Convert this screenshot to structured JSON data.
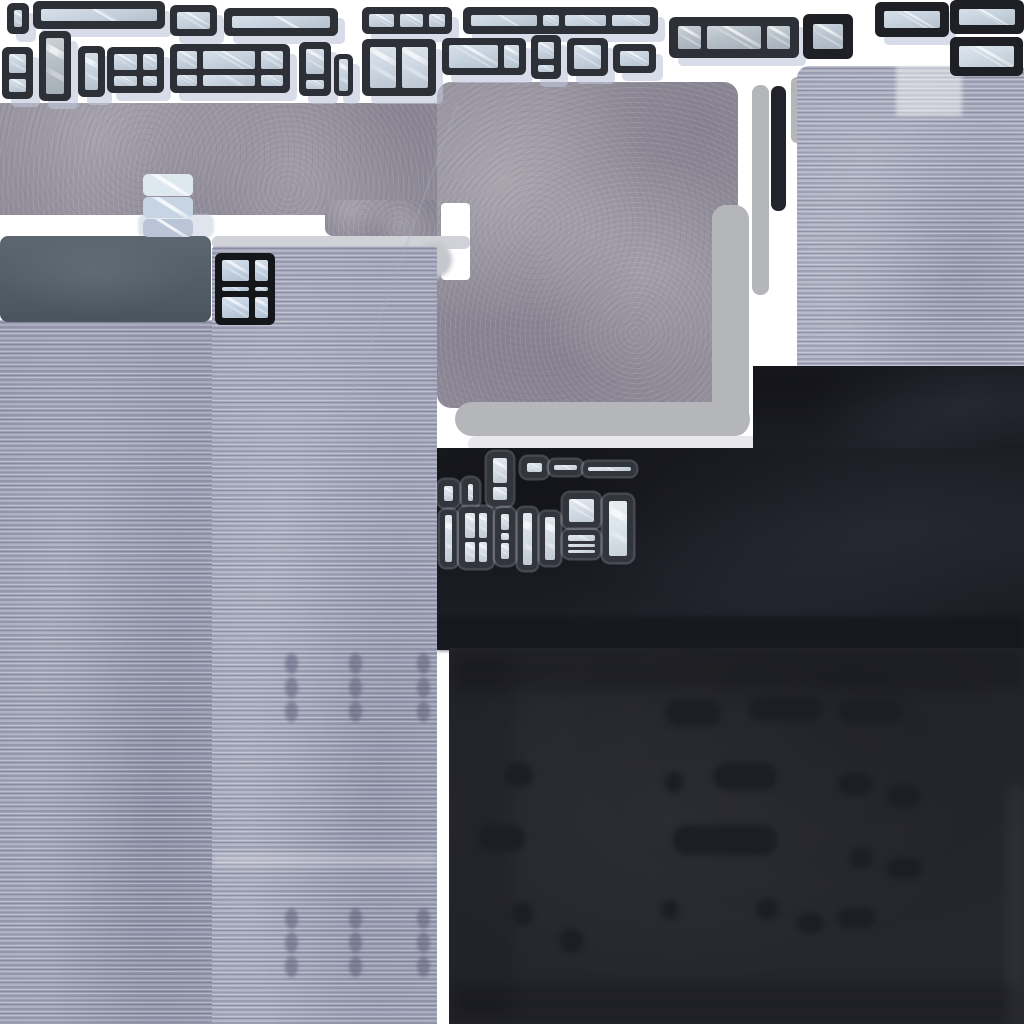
{
  "meta": {
    "description": "hand-painted building texture atlas sprite sheet",
    "canvas": {
      "width": 1024,
      "height": 1024,
      "background": "#ffffff"
    }
  },
  "palette": {
    "background_white": "#ffffff",
    "window_frame_charcoal": "#2d3037",
    "window_frame_black": "#1e2025",
    "glass_blue": "#c7d3df",
    "glass_gray": "#b6bfc8",
    "glass_bright": "#d4dde6",
    "concrete_gray": "#938f9b",
    "siding_lavender_left": "#9b9eb2",
    "siding_lavender_right": "#a2a5b9",
    "siding_panel_topright": "#a6a9bc",
    "slate_cap": "#4e5a64",
    "dark_wall": "#1c1d24",
    "dark_roof": "#26272e",
    "roof_blob": "#1d1e25",
    "pipe_gray": "#b5b6ba",
    "pipe_light": "#e8e8ec",
    "shadow_periwinkle": "rgba(188,197,216,0.60)"
  },
  "regions": [
    {
      "name": "concrete-wall-strip",
      "kind": "concrete",
      "x": 0,
      "y": 103,
      "w": 437,
      "h": 112,
      "r": "0 0 8px 0"
    },
    {
      "name": "concrete-wall-strip-step",
      "kind": "concrete",
      "x": 325,
      "y": 200,
      "w": 112,
      "h": 36,
      "r": "0 0 0 8px"
    },
    {
      "name": "concrete-wall-square",
      "kind": "concrete",
      "x": 437,
      "y": 82,
      "w": 301,
      "h": 326,
      "r": "14px"
    },
    {
      "name": "concrete-notch-white",
      "kind": "flat",
      "x": 441,
      "y": 203,
      "w": 29,
      "h": 77,
      "c": "#ffffff",
      "r": "4px"
    },
    {
      "name": "ledge-strip",
      "kind": "flat",
      "x": 212,
      "y": 236,
      "w": 258,
      "h": 13,
      "c": "#d0d2d7",
      "r": "6px"
    },
    {
      "name": "ledge-bump",
      "kind": "flat",
      "x": 416,
      "y": 242,
      "w": 36,
      "h": 36,
      "c": "#c5c7cd",
      "r": "50%",
      "blur": 2
    },
    {
      "name": "chimney-shadow",
      "kind": "flat",
      "x": 138,
      "y": 214,
      "w": 76,
      "h": 24,
      "c": "rgba(198,207,222,0.55)",
      "r": "8px",
      "blur": 1
    },
    {
      "name": "pipe-horizontal",
      "kind": "flat",
      "x": 455,
      "y": 402,
      "w": 295,
      "h": 34,
      "c": "#b5b6ba",
      "r": "17px"
    },
    {
      "name": "pipe-horizontal-light",
      "kind": "flat",
      "x": 468,
      "y": 436,
      "w": 334,
      "h": 16,
      "c": "#e8e8ec",
      "r": "8px"
    },
    {
      "name": "pipe-vertical-wide",
      "kind": "flat",
      "x": 712,
      "y": 205,
      "w": 37,
      "h": 231,
      "c": "#b5b6ba",
      "r": "14px"
    },
    {
      "name": "pipe-vertical-thin",
      "kind": "flat",
      "x": 752,
      "y": 85,
      "w": 17,
      "h": 210,
      "c": "#b5b6ba",
      "r": "8px"
    },
    {
      "name": "pipe-stub",
      "kind": "flat",
      "x": 791,
      "y": 77,
      "w": 13,
      "h": 66,
      "c": "#b5b6ba",
      "r": "6px"
    },
    {
      "name": "antenna-black-bar",
      "kind": "flat",
      "x": 771,
      "y": 86,
      "w": 15,
      "h": 125,
      "c": "#23242b",
      "r": "7px"
    },
    {
      "name": "siding-panel-top-right",
      "kind": "corrugated",
      "x": 797,
      "y": 66,
      "w": 227,
      "h": 300,
      "base": "#a6a9bc",
      "r": "12px 4px 0 0"
    },
    {
      "name": "siding-haze-patch",
      "kind": "flat",
      "x": 896,
      "y": 64,
      "w": 66,
      "h": 52,
      "c": "rgba(255,255,255,0.45)",
      "blur": 2
    },
    {
      "name": "dark-wall-right",
      "kind": "darkwall",
      "x": 753,
      "y": 366,
      "w": 271,
      "h": 96
    },
    {
      "name": "dark-wall-main",
      "kind": "darkwall",
      "x": 437,
      "y": 448,
      "w": 587,
      "h": 202
    },
    {
      "name": "dark-wall-bottom-band",
      "kind": "flat",
      "x": 437,
      "y": 616,
      "w": 587,
      "h": 34,
      "c": "#17181f",
      "o": 0.85,
      "blur": 2
    },
    {
      "name": "roof-texture",
      "kind": "roof",
      "x": 449,
      "y": 648,
      "w": 575,
      "h": 376,
      "shades": [
        {
          "x": 0,
          "y": 0,
          "w": 575,
          "h": 42,
          "c": "rgba(0,0,0,0.16)"
        },
        {
          "x": 0,
          "y": 336,
          "w": 575,
          "h": 40,
          "c": "rgba(0,0,0,0.16)"
        },
        {
          "x": 0,
          "y": 0,
          "w": 64,
          "h": 376,
          "c": "rgba(0,0,0,0.10)"
        },
        {
          "x": 559,
          "y": 140,
          "w": 16,
          "h": 236,
          "c": "rgba(255,255,255,0.05)"
        }
      ],
      "blobs": [
        {
          "x": 216,
          "y": 52,
          "w": 56,
          "h": 26
        },
        {
          "x": 299,
          "y": 49,
          "w": 74,
          "h": 24
        },
        {
          "x": 389,
          "y": 52,
          "w": 64,
          "h": 22
        },
        {
          "x": 56,
          "y": 115,
          "w": 28,
          "h": 24
        },
        {
          "x": 216,
          "y": 124,
          "w": 18,
          "h": 21
        },
        {
          "x": 264,
          "y": 115,
          "w": 64,
          "h": 27
        },
        {
          "x": 389,
          "y": 125,
          "w": 34,
          "h": 22
        },
        {
          "x": 438,
          "y": 137,
          "w": 33,
          "h": 22
        },
        {
          "x": 29,
          "y": 177,
          "w": 47,
          "h": 26
        },
        {
          "x": 224,
          "y": 177,
          "w": 104,
          "h": 30
        },
        {
          "x": 401,
          "y": 200,
          "w": 23,
          "h": 20
        },
        {
          "x": 438,
          "y": 210,
          "w": 35,
          "h": 20
        },
        {
          "x": 63,
          "y": 254,
          "w": 21,
          "h": 23
        },
        {
          "x": 213,
          "y": 252,
          "w": 16,
          "h": 20
        },
        {
          "x": 308,
          "y": 250,
          "w": 21,
          "h": 22
        },
        {
          "x": 348,
          "y": 265,
          "w": 26,
          "h": 20
        },
        {
          "x": 389,
          "y": 260,
          "w": 37,
          "h": 20
        },
        {
          "x": 111,
          "y": 280,
          "w": 23,
          "h": 25
        }
      ],
      "blob_color": "#1d1e25"
    },
    {
      "name": "siding-tower-right",
      "kind": "corrugated",
      "x": 212,
      "y": 246,
      "w": 225,
      "h": 778,
      "base": "#a2a5b9",
      "r": "4px 4px 0 0",
      "bands": [
        {
          "x": 0,
          "y": 607,
          "w": 225,
          "h": 14,
          "c": "rgba(255,255,255,0.22)"
        }
      ],
      "rivets": {
        "cols": [
          73,
          137,
          205
        ],
        "rows": [
          407,
          431,
          455,
          662,
          686,
          710
        ],
        "w": 13,
        "h": 21,
        "c": "rgba(88,92,118,0.5)"
      }
    },
    {
      "name": "siding-tower-left",
      "kind": "corrugated",
      "x": 0,
      "y": 320,
      "w": 212,
      "h": 704,
      "base": "#9b9eb2"
    },
    {
      "name": "rooftop-slate-cap",
      "kind": "cap",
      "x": 0,
      "y": 236,
      "w": 211,
      "h": 86,
      "r": "8px"
    },
    {
      "name": "scratch-line",
      "kind": "flat",
      "x": 400,
      "y": 95,
      "w": 2,
      "h": 330,
      "c": "rgba(170,175,190,0.30)",
      "rot": 20
    }
  ],
  "chimney": {
    "name": "glass-chimney",
    "x": 143,
    "y": 174,
    "w": 50,
    "h": 63,
    "segments": [
      {
        "c": "#dde8ef",
        "h": 1.1
      },
      {
        "c": "#c6d4e3",
        "h": 1.0
      },
      {
        "c": "#b9c4d6",
        "h": 0.9
      }
    ]
  },
  "window_defaults": {
    "frame": "#2d3037",
    "glass": "#c7d3df",
    "frame_width": 7,
    "mullion": 6,
    "radius": 6,
    "shadow": true
  },
  "windows": [
    {
      "name": "window-sprite-tiny",
      "x": 7,
      "y": 3,
      "w": 22,
      "h": 31
    },
    {
      "name": "window-sprite-long-top",
      "x": 33,
      "y": 1,
      "w": 132,
      "h": 28,
      "f": 8
    },
    {
      "name": "window-sprite-square-small",
      "x": 170,
      "y": 5,
      "w": 47,
      "h": 31
    },
    {
      "name": "window-sprite-wide",
      "x": 224,
      "y": 8,
      "w": 114,
      "h": 28,
      "f": 8
    },
    {
      "name": "window-sprite-strip-3pane",
      "x": 362,
      "y": 7,
      "w": 90,
      "h": 27,
      "cols": [
        1.6,
        1.5,
        1
      ]
    },
    {
      "name": "window-sprite-strip-4pane",
      "x": 463,
      "y": 7,
      "w": 195,
      "h": 27,
      "f": 8,
      "cols": [
        4.5,
        1.1,
        2.8,
        2.6
      ]
    },
    {
      "name": "window-sprite-banded",
      "x": 669,
      "y": 17,
      "w": 130,
      "h": 41,
      "f": 9,
      "cols": [
        1,
        2.4,
        1
      ],
      "glass": "#b6bfc8"
    },
    {
      "name": "window-sprite-square-thick",
      "x": 803,
      "y": 14,
      "w": 50,
      "h": 45,
      "f": 10,
      "frame": "#1e2025",
      "glass": "#b9c4cf",
      "shadow": false
    },
    {
      "name": "window-sprite-black-wide",
      "x": 875,
      "y": 2,
      "w": 74,
      "h": 35,
      "f": 9,
      "frame": "#1e2025"
    },
    {
      "name": "window-sprite-black-corner",
      "x": 950,
      "y": 0,
      "w": 74,
      "h": 34,
      "f": 9,
      "frame": "#1e2025",
      "shadow": false
    },
    {
      "name": "window-sprite-black-lower",
      "x": 950,
      "y": 37,
      "w": 73,
      "h": 39,
      "f": 9,
      "frame": "#1e2025",
      "glass": "#cfdae4",
      "shadow": false
    },
    {
      "name": "window-sprite-stacked",
      "x": 2,
      "y": 47,
      "w": 31,
      "h": 52,
      "rows": [
        1.4,
        1
      ]
    },
    {
      "name": "window-sprite-tall-gray",
      "x": 39,
      "y": 31,
      "w": 32,
      "h": 70,
      "glass": "#b6bec5"
    },
    {
      "name": "window-sprite-narrow",
      "x": 78,
      "y": 46,
      "w": 27,
      "h": 51
    },
    {
      "name": "window-sprite-grid-2x2",
      "x": 107,
      "y": 47,
      "w": 57,
      "h": 46,
      "cols": [
        1.6,
        1
      ],
      "rows": [
        1.6,
        1
      ]
    },
    {
      "name": "window-sprite-grid-3x2",
      "x": 170,
      "y": 44,
      "w": 120,
      "h": 49,
      "cols": [
        1,
        2.6,
        1.1
      ],
      "rows": [
        1.7,
        1
      ]
    },
    {
      "name": "window-sprite-stacked-2",
      "x": 299,
      "y": 42,
      "w": 32,
      "h": 54,
      "rows": [
        2.6,
        1
      ]
    },
    {
      "name": "window-sprite-slim",
      "x": 334,
      "y": 54,
      "w": 19,
      "h": 42,
      "f": 5,
      "m": 4
    },
    {
      "name": "window-sprite-double-door",
      "x": 362,
      "y": 39,
      "w": 74,
      "h": 57,
      "f": 8,
      "cols": [
        1,
        1
      ],
      "glass": "#cdd8e3"
    },
    {
      "name": "window-sprite-wide-2pane",
      "x": 442,
      "y": 38,
      "w": 84,
      "h": 37,
      "cols": [
        3.2,
        1
      ]
    },
    {
      "name": "window-sprite-stacked-3",
      "x": 531,
      "y": 35,
      "w": 30,
      "h": 44,
      "rows": [
        2.2,
        1
      ]
    },
    {
      "name": "window-sprite-square-mid",
      "x": 567,
      "y": 38,
      "w": 41,
      "h": 38
    },
    {
      "name": "window-sprite-small-wide",
      "x": 613,
      "y": 44,
      "w": 43,
      "h": 29
    },
    {
      "name": "cluster-window-tiny-a",
      "x": 438,
      "y": 480,
      "w": 21,
      "h": 27,
      "frame": "#33353c",
      "glass": "#d4dde6",
      "f": 6,
      "m": 4,
      "radius": 7,
      "shadow": false,
      "outline": true
    },
    {
      "name": "cluster-window-tiny-b",
      "x": 462,
      "y": 478,
      "w": 17,
      "h": 29,
      "frame": "#33353c",
      "glass": "#d4dde6",
      "f": 6,
      "m": 4,
      "radius": 7,
      "shadow": false,
      "outline": true
    },
    {
      "name": "cluster-window-tall-split",
      "x": 487,
      "y": 452,
      "w": 26,
      "h": 54,
      "rows": [
        2,
        1
      ],
      "frame": "#33353c",
      "glass": "#d4dde6",
      "f": 6,
      "m": 4,
      "radius": 7,
      "shadow": false,
      "outline": true
    },
    {
      "name": "cluster-window-small",
      "x": 521,
      "y": 457,
      "w": 27,
      "h": 21,
      "frame": "#33353c",
      "glass": "#d4dde6",
      "f": 6,
      "m": 4,
      "radius": 7,
      "shadow": false,
      "outline": true
    },
    {
      "name": "cluster-window-strip-a",
      "x": 549,
      "y": 460,
      "w": 33,
      "h": 15,
      "frame": "#33353c",
      "glass": "#d4dde6",
      "f": 5,
      "m": 4,
      "radius": 6,
      "shadow": false,
      "outline": true
    },
    {
      "name": "cluster-window-strip-b",
      "x": 583,
      "y": 462,
      "w": 53,
      "h": 14,
      "frame": "#33353c",
      "glass": "#d4dde6",
      "f": 5,
      "m": 4,
      "radius": 6,
      "shadow": false,
      "outline": true
    },
    {
      "name": "cluster-window-slim-a",
      "x": 440,
      "y": 510,
      "w": 17,
      "h": 57,
      "frame": "#33353c",
      "glass": "#d4dde6",
      "f": 5,
      "m": 4,
      "radius": 6,
      "shadow": false,
      "outline": true
    },
    {
      "name": "cluster-window-grid",
      "x": 459,
      "y": 507,
      "w": 34,
      "h": 61,
      "cols": [
        1.2,
        1
      ],
      "rows": [
        1.2,
        1
      ],
      "frame": "#33353c",
      "glass": "#d4dde6",
      "f": 6,
      "m": 4,
      "radius": 7,
      "shadow": false,
      "outline": true
    },
    {
      "name": "cluster-window-triple-stack",
      "x": 495,
      "y": 508,
      "w": 20,
      "h": 57,
      "rows": [
        2,
        1,
        2
      ],
      "frame": "#33353c",
      "glass": "#d4dde6",
      "f": 6,
      "m": 3,
      "radius": 7,
      "shadow": false,
      "outline": true
    },
    {
      "name": "cluster-window-slim-b",
      "x": 518,
      "y": 508,
      "w": 19,
      "h": 62,
      "frame": "#33353c",
      "glass": "#d4dde6",
      "f": 5,
      "m": 4,
      "radius": 6,
      "shadow": false,
      "outline": true
    },
    {
      "name": "cluster-window-slim-c",
      "x": 540,
      "y": 512,
      "w": 20,
      "h": 53,
      "frame": "#33353c",
      "glass": "#d4dde6",
      "f": 5,
      "m": 4,
      "radius": 6,
      "shadow": false,
      "outline": true
    },
    {
      "name": "cluster-window-square-top",
      "x": 563,
      "y": 493,
      "w": 37,
      "h": 35,
      "frame": "#33353c",
      "glass": "#d4dde6",
      "f": 6,
      "m": 4,
      "radius": 7,
      "shadow": false,
      "outline": true
    },
    {
      "name": "cluster-window-square-bottom",
      "x": 563,
      "y": 530,
      "w": 37,
      "h": 28,
      "rows": [
        2.2,
        1,
        1
      ],
      "frame": "#33353c",
      "glass": "#d4dde6",
      "f": 5,
      "m": 3,
      "radius": 7,
      "shadow": false,
      "outline": true
    },
    {
      "name": "cluster-window-tall",
      "x": 603,
      "y": 495,
      "w": 30,
      "h": 67,
      "frame": "#33353c",
      "glass": "#dde6ed",
      "f": 6,
      "m": 4,
      "radius": 7,
      "shadow": false,
      "outline": true
    },
    {
      "name": "tower-window",
      "x": 215,
      "y": 253,
      "w": 60,
      "h": 72,
      "frame": "#15161a",
      "f": 7,
      "m": 6,
      "cols": [
        2,
        1
      ],
      "rows": [
        10,
        2,
        10
      ],
      "glass": "#c3d2e2",
      "shadow": false
    }
  ]
}
